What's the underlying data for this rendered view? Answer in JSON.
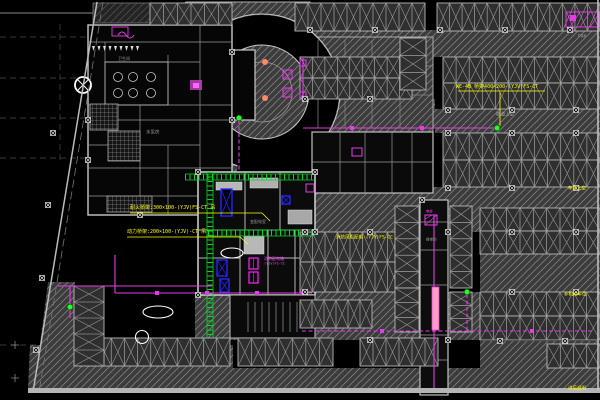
{
  "drawing": {
    "type": "cad-floor-plan",
    "description": "underground garage electrical plan"
  },
  "colors": {
    "background": "#000000",
    "hatch_fill": "#3c3c3c",
    "hatch_line": "#7d7d7d",
    "hatch_dark_fill": "#242424",
    "hatch_dark_line": "#555555",
    "stall_fill": "#2f2f2f",
    "stall_line": "#b8b8b8",
    "stall_x": "#999999",
    "wall": "#c8c8c8",
    "wall_dim": "#8a8a8a",
    "tray_green": "#00dd22",
    "feeder_magenta": "#e83ae8",
    "accent_blue": "#2a2aff",
    "note_yellow": "#ffff00",
    "node_green": "#22ff22",
    "dot_orange": "#ff8866",
    "cloud_white": "#ffffff",
    "riser_pink": "#ff9fc0",
    "grid_dash": "#4a4a4a",
    "room_text": "#9a9a9a"
  },
  "labels": [
    {
      "id": "tray-note-top",
      "text": "WE-4B 桥架400×200-(YJV)FS-CT",
      "x": 456,
      "y": 90,
      "color": "#ffff00",
      "size": 5
    },
    {
      "id": "ramp-air-note",
      "text": "坡道上空",
      "x": 496,
      "y": 118,
      "color": "#b0b0b0",
      "size": 4.5
    },
    {
      "id": "tray-note-fire",
      "text": "耐火桥架:300×100-(YJV)FS-CT 吊",
      "x": 130,
      "y": 211,
      "color": "#ffff00",
      "size": 5
    },
    {
      "id": "tray-note-power",
      "text": "动力桥架:200×100-(YJV)-CT 吊",
      "x": 127,
      "y": 235,
      "color": "#ffff00",
      "size": 5
    },
    {
      "id": "dist-note",
      "text": "消防风机配电-(YJV)FS-CC",
      "x": 336,
      "y": 241,
      "color": "#ffff00",
      "size": 4.5
    },
    {
      "id": "lane-air-note",
      "text": "车道上空",
      "x": 568,
      "y": 192,
      "color": "#ffff00",
      "size": 4.5
    },
    {
      "id": "parking-note",
      "text": "非机动车位",
      "x": 564,
      "y": 298,
      "color": "#ffff00",
      "size": 4.5
    },
    {
      "id": "ref-note",
      "text": "详见说明",
      "x": 568,
      "y": 392,
      "color": "#ffff00",
      "size": 4.5
    },
    {
      "id": "panel-note-1",
      "text": "消防配电箱",
      "x": 264,
      "y": 261,
      "color": "#ff44ff",
      "size": 4
    },
    {
      "id": "panel-note-2",
      "text": "(YJV)FS-CC",
      "x": 264,
      "y": 266,
      "color": "#ff44ff",
      "size": 3.5
    },
    {
      "id": "room-pump",
      "text": "水泵房",
      "x": 146,
      "y": 136,
      "color": "#9a9a9a",
      "size": 4.5
    },
    {
      "id": "room-wc",
      "text": "卫生间",
      "x": 118,
      "y": 61,
      "color": "#9a9a9a",
      "size": 4
    },
    {
      "id": "room-substation",
      "text": "变配电室",
      "x": 250,
      "y": 224,
      "color": "#9a9a9a",
      "size": 4
    },
    {
      "id": "room-stair",
      "text": "楼梯间",
      "x": 426,
      "y": 242,
      "color": "#9a9a9a",
      "size": 3.5
    },
    {
      "id": "shaft-note",
      "text": "电井",
      "x": 426,
      "y": 214,
      "color": "#ff44ff",
      "size": 3.5
    },
    {
      "id": "grid-ref",
      "text": "P8#",
      "x": 578,
      "y": 40,
      "color": "#9a9a9a",
      "size": 4.5
    }
  ]
}
